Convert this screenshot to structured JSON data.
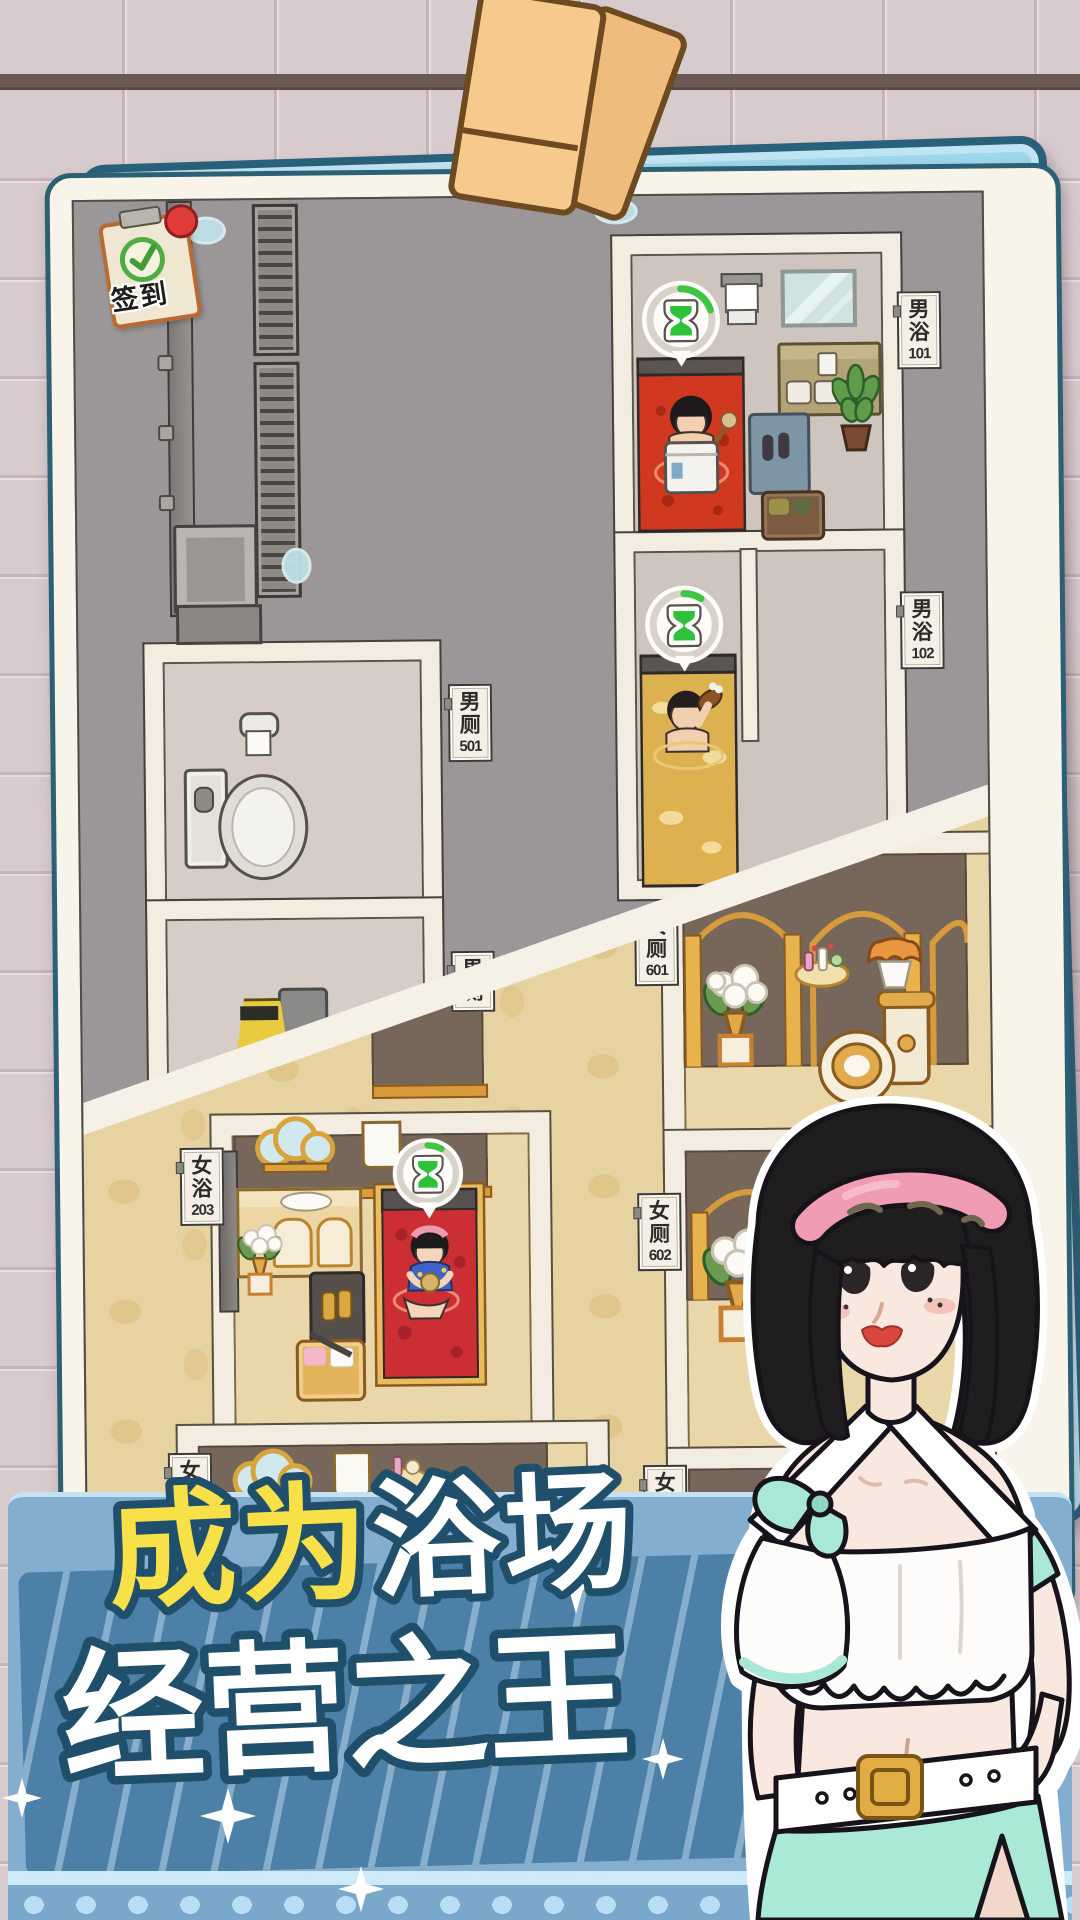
{
  "signin": {
    "label": "签到"
  },
  "promo": {
    "title_part1": "成为",
    "title_part2": "浴场",
    "title_line2": "经营之王"
  },
  "rooms": {
    "mens_bath_101": {
      "name": "男浴",
      "number": "101"
    },
    "mens_bath_102": {
      "name": "男浴",
      "number": "102"
    },
    "mens_toilet_501": {
      "name": "男厕",
      "number": "501"
    },
    "mens_toilet_extra": {
      "name": "男厕",
      "number": ""
    },
    "womens_bath_203": {
      "name": "女浴",
      "number": "203"
    },
    "womens_toilet_601": {
      "name": "女厕",
      "number": "601"
    },
    "womens_toilet_602": {
      "name": "女厕",
      "number": "602"
    },
    "womens_toilet_603": {
      "name": "女厕",
      "number": "603"
    },
    "womens_bath_partial": {
      "name": "女",
      "number": ""
    }
  },
  "timers": {
    "mens_bath_101": 0.2,
    "mens_bath_102": 0.09,
    "womens_bath_203": 0.08
  },
  "icons": {
    "timer": "hourglass-icon",
    "signin": "check-icon",
    "sparkle": "four-point-star-icon"
  },
  "colors": {
    "card_border": "#2c6075",
    "card_blue": "#9ed6ea",
    "banner_blue": "#84aecf",
    "panel_blue": "#4d80a7",
    "title_yellow": "#f8e049",
    "title_outline": "#1f4f6b",
    "bath_red": "#d0391f",
    "bath_yellow": "#ddb050",
    "luxury_gold": "#d9a43c",
    "timer_green": "#2ec23b",
    "mint": "#a9e8d6",
    "headband_pink": "#f09cb2",
    "tile_pink": "#d8cbce"
  }
}
